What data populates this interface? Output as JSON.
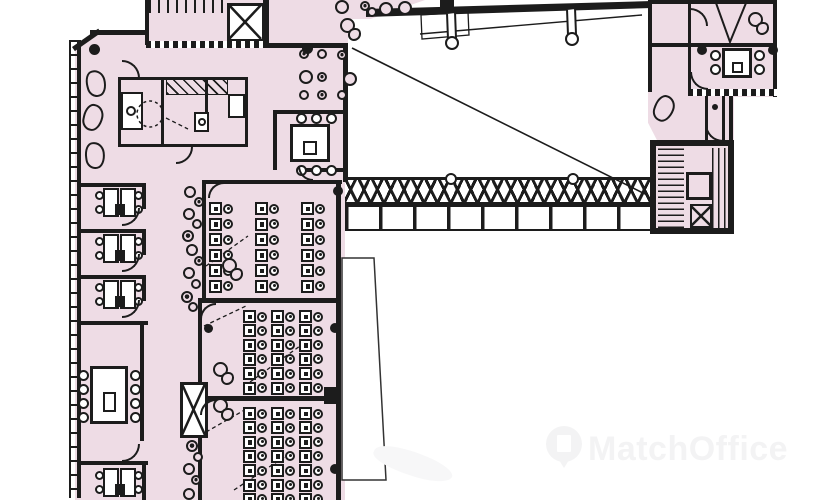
{
  "watermark": {
    "text": "MatchOffice",
    "logo": "map-pin-building-icon",
    "text_color": "#f3f3f4",
    "swoosh_color": "#f7f7f8"
  },
  "colors": {
    "room_fill": "#eedce5",
    "wall": "#1c1c1c",
    "background": "#ffffff"
  },
  "plan": {
    "type": "office-floor-plan",
    "areas": [
      "stair-core-top-left",
      "elevator-top",
      "kitchen-breakout",
      "lounge-beans",
      "meeting-room-top",
      "cafe-seating",
      "atrium-void",
      "glazed-truss-bridge",
      "cell-offices-left",
      "long-meeting-room-left",
      "corridor-left",
      "elevator-shaft-corridor",
      "open-plan-room-1",
      "open-plan-room-2",
      "open-plan-room-3",
      "terrace-void",
      "right-wing-office",
      "meeting-room-right",
      "stair-core-right"
    ]
  },
  "furniture": {
    "desk_rooms": [
      {
        "name": "open-plan-room-1",
        "cols": [
          209,
          255,
          301
        ],
        "row_y0": 202,
        "rows": 6,
        "row_dy": 15.5
      },
      {
        "name": "open-plan-room-2",
        "cols": [
          243,
          271,
          299
        ],
        "row_y0": 310,
        "rows": 6,
        "row_dy": 14.3
      },
      {
        "name": "open-plan-room-3",
        "cols": [
          243,
          271,
          299
        ],
        "row_y0": 407,
        "rows": 7,
        "row_dy": 14.3
      }
    ],
    "office_desk_pairs": [
      {
        "x": 96,
        "y": 188
      },
      {
        "x": 96,
        "y": 234
      },
      {
        "x": 96,
        "y": 280
      },
      {
        "x": 96,
        "y": 468
      }
    ],
    "meeting_tables": [
      {
        "x": 290,
        "y": 124,
        "w": 40,
        "h": 38,
        "chairs": [
          [
            296,
            113
          ],
          [
            311,
            113
          ],
          [
            326,
            113
          ],
          [
            296,
            165
          ],
          [
            311,
            165
          ],
          [
            326,
            165
          ]
        ]
      },
      {
        "x": 90,
        "y": 366,
        "w": 38,
        "h": 58,
        "chairs": [
          [
            78,
            370
          ],
          [
            78,
            384
          ],
          [
            78,
            398
          ],
          [
            78,
            412
          ],
          [
            130,
            370
          ],
          [
            130,
            384
          ],
          [
            130,
            398
          ],
          [
            130,
            412
          ]
        ]
      },
      {
        "x": 722,
        "y": 48,
        "w": 30,
        "h": 30,
        "chairs": [
          [
            710,
            50
          ],
          [
            710,
            64
          ],
          [
            754,
            50
          ],
          [
            754,
            64
          ]
        ]
      }
    ],
    "cafe_circles": [
      {
        "x": 299,
        "y": 70,
        "r": 7,
        "dark": false
      },
      {
        "x": 343,
        "y": 72,
        "r": 7,
        "dark": false
      },
      {
        "x": 335,
        "y": 0,
        "r": 7,
        "dark": false
      },
      {
        "x": 379,
        "y": 2,
        "r": 7,
        "dark": false
      },
      {
        "x": 398,
        "y": 1,
        "r": 7,
        "dark": false
      },
      {
        "x": 299,
        "y": 49,
        "r": 5,
        "dark": true
      },
      {
        "x": 317,
        "y": 49,
        "r": 5,
        "dark": false
      },
      {
        "x": 337,
        "y": 50,
        "r": 5,
        "dark": true
      },
      {
        "x": 317,
        "y": 72,
        "r": 5,
        "dark": true
      },
      {
        "x": 299,
        "y": 90,
        "r": 5,
        "dark": false
      },
      {
        "x": 317,
        "y": 90,
        "r": 5,
        "dark": true
      },
      {
        "x": 337,
        "y": 90,
        "r": 5,
        "dark": false
      },
      {
        "x": 360,
        "y": 1,
        "r": 5,
        "dark": true
      },
      {
        "x": 367,
        "y": 7,
        "r": 5,
        "dark": false
      }
    ],
    "corridor_stools": [
      {
        "x": 184,
        "y": 186,
        "r": 6,
        "dark": false
      },
      {
        "x": 194,
        "y": 197,
        "r": 5,
        "dark": true
      },
      {
        "x": 183,
        "y": 208,
        "r": 6,
        "dark": false
      },
      {
        "x": 192,
        "y": 219,
        "r": 5,
        "dark": false
      },
      {
        "x": 182,
        "y": 230,
        "r": 6,
        "dark": true
      },
      {
        "x": 186,
        "y": 244,
        "r": 6,
        "dark": false
      },
      {
        "x": 194,
        "y": 256,
        "r": 5,
        "dark": true
      },
      {
        "x": 183,
        "y": 267,
        "r": 6,
        "dark": false
      },
      {
        "x": 191,
        "y": 279,
        "r": 5,
        "dark": false
      },
      {
        "x": 181,
        "y": 291,
        "r": 6,
        "dark": true
      },
      {
        "x": 188,
        "y": 302,
        "r": 5,
        "dark": false
      },
      {
        "x": 186,
        "y": 440,
        "r": 6,
        "dark": true
      },
      {
        "x": 193,
        "y": 452,
        "r": 5,
        "dark": false
      },
      {
        "x": 183,
        "y": 463,
        "r": 6,
        "dark": false
      },
      {
        "x": 191,
        "y": 475,
        "r": 5,
        "dark": true
      },
      {
        "x": 183,
        "y": 488,
        "r": 6,
        "dark": false
      }
    ],
    "column_dots": [
      {
        "x": 89,
        "y": 44,
        "d": 11
      },
      {
        "x": 302,
        "y": 43,
        "d": 11
      },
      {
        "x": 333,
        "y": 186,
        "d": 10
      },
      {
        "x": 330,
        "y": 323,
        "d": 10
      },
      {
        "x": 330,
        "y": 464,
        "d": 10
      },
      {
        "x": 697,
        "y": 45,
        "d": 10
      },
      {
        "x": 768,
        "y": 45,
        "d": 10
      },
      {
        "x": 712,
        "y": 104,
        "d": 6
      },
      {
        "x": 204,
        "y": 324,
        "d": 9
      },
      {
        "x": 128,
        "y": 108,
        "d": 0
      }
    ],
    "dark_rects": [
      {
        "x": 324,
        "y": 387,
        "w": 17,
        "h": 17
      },
      {
        "x": 440,
        "y": 0,
        "w": 14,
        "h": 8
      }
    ],
    "door_arcs": [
      {
        "x": 122,
        "y": 208,
        "r": 18,
        "dir": "se"
      },
      {
        "x": 122,
        "y": 254,
        "r": 18,
        "dir": "se"
      },
      {
        "x": 122,
        "y": 300,
        "r": 18,
        "dir": "se"
      },
      {
        "x": 122,
        "y": 444,
        "r": 18,
        "dir": "se"
      },
      {
        "x": 122,
        "y": 60,
        "r": 18,
        "dir": "ne"
      },
      {
        "x": 176,
        "y": 147,
        "r": 17,
        "dir": "se"
      },
      {
        "x": 298,
        "y": 166,
        "r": 15,
        "dir": "sw"
      },
      {
        "x": 208,
        "y": 182,
        "r": 16,
        "dir": "nw"
      },
      {
        "x": 200,
        "y": 303,
        "r": 16,
        "dir": "nw"
      },
      {
        "x": 200,
        "y": 399,
        "r": 16,
        "dir": "nw"
      },
      {
        "x": 690,
        "y": 8,
        "r": 18,
        "dir": "ne"
      },
      {
        "x": 690,
        "y": 72,
        "r": 18,
        "dir": "sw"
      },
      {
        "x": 705,
        "y": 124,
        "r": 18,
        "dir": "sw"
      }
    ],
    "beans": [
      {
        "x": 86,
        "y": 70,
        "rot": -15
      },
      {
        "x": 83,
        "y": 104,
        "rot": 12
      },
      {
        "x": 85,
        "y": 142,
        "rot": -8
      },
      {
        "x": 654,
        "y": 95,
        "rot": 20
      }
    ],
    "squiggles": [
      {
        "x": 340,
        "y": 18
      },
      {
        "x": 222,
        "y": 258
      },
      {
        "x": 213,
        "y": 362
      },
      {
        "x": 213,
        "y": 398
      },
      {
        "x": 748,
        "y": 12
      }
    ],
    "kitchen_chairs": [
      {
        "x": 126,
        "y": 106,
        "d": 10
      }
    ]
  }
}
